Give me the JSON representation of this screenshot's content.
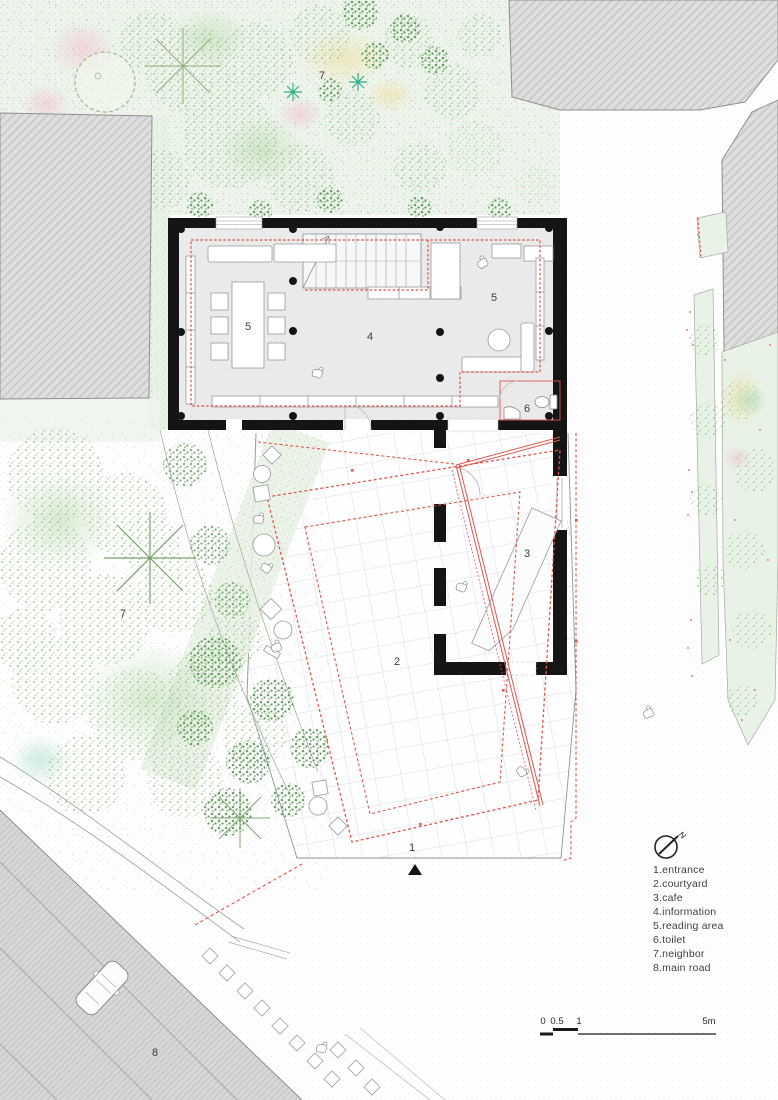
{
  "plan_labels": {
    "neighbor_top": "7",
    "reading_area_table": "5",
    "information": "4",
    "reading_area_lounge": "5",
    "toilet": "6",
    "cafe": "3",
    "courtyard": "2",
    "entrance": "1",
    "neighbor_west": "7",
    "main_road": "8"
  },
  "legend": {
    "items": [
      "1.entrance",
      "2.courtyard",
      "3.cafe",
      "4.information",
      "5.reading area",
      "6.toilet",
      "7.neighbor",
      "8.main road"
    ]
  },
  "scale_bar": {
    "labels": [
      "0",
      "0.5",
      "1",
      "5m"
    ]
  },
  "compass": {
    "north_label": "N"
  },
  "colors": {
    "wall_black": "#151515",
    "annotation_red": "#e0574e",
    "vegetation_green": "#7fb276",
    "neighbor_gray": "#dedede",
    "grid_line": "#d8dce0"
  }
}
